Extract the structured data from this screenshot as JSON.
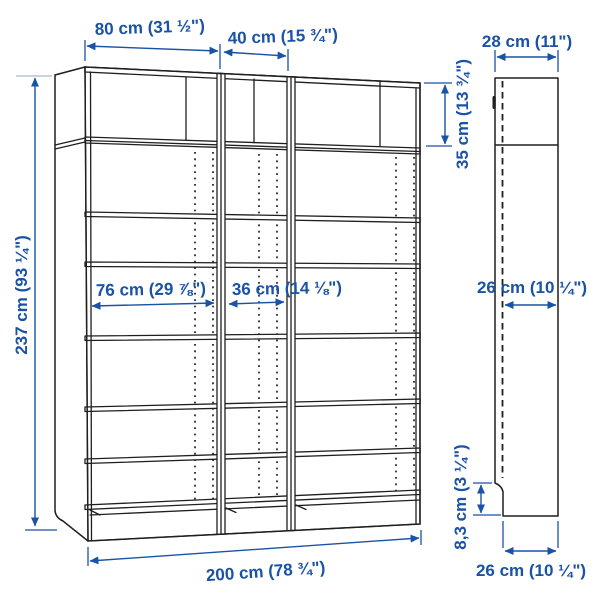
{
  "page": {
    "background": "#ffffff"
  },
  "colors": {
    "dimension_blue": "#1a52a6",
    "line_dark": "#1f1f1f",
    "tick_light": "#a9b6cc"
  },
  "diagram": {
    "type": "furniture-dimension-diagram",
    "views": {
      "front": {
        "sections": 3,
        "dimensions": {
          "section_width_left": "80 cm (31 ½\")",
          "section_width_middle": "40 cm (15 ¾\")",
          "total_height": "237 cm (93 ¼\")",
          "top_section_height": "35 cm (13 ¾\")",
          "inner_width_left": "76 cm (29 ⅞\")",
          "inner_width_middle": "36 cm (14 ⅛\")",
          "total_width": "200 cm (78 ¾\")"
        }
      },
      "side": {
        "dimensions": {
          "depth": "28 cm (11\")",
          "inner_depth": "26 cm (10 ¼\")",
          "plinth_height": "8,3 cm (3 ¼\")",
          "base_depth": "26 cm (10 ¼\")"
        }
      }
    }
  }
}
